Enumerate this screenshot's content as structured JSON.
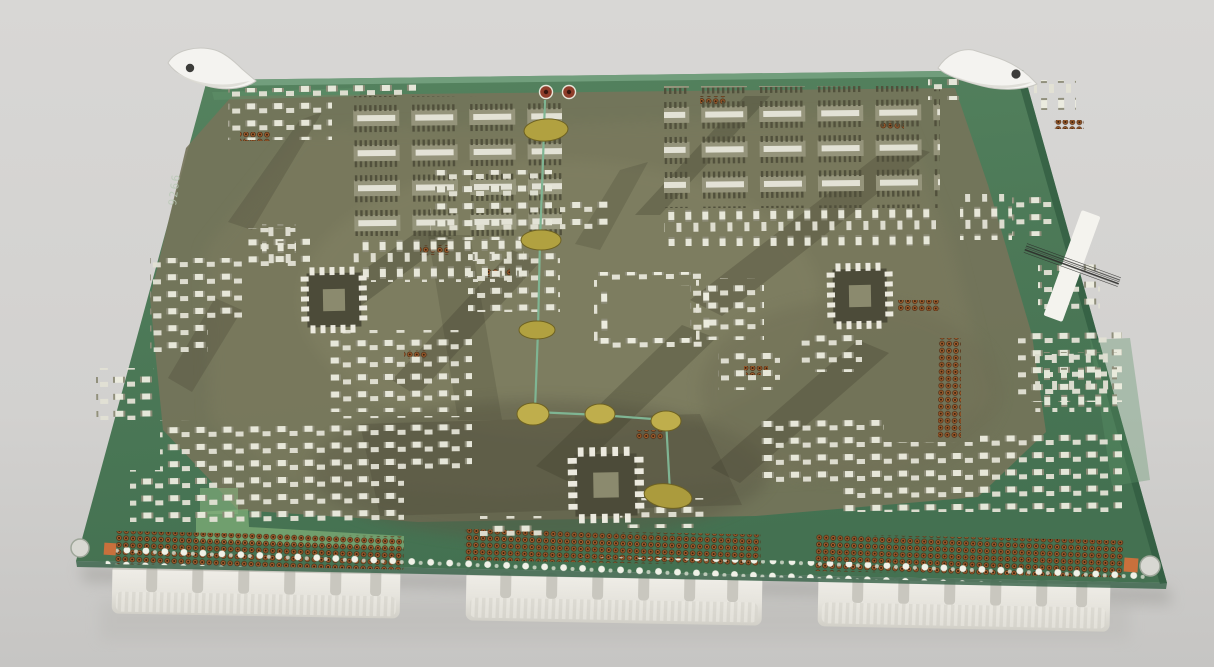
{
  "photo": {
    "subject": "green printed circuit board viewed at an angle on a gray surface",
    "board": {
      "silkscreen_marking": "9266",
      "edge_connector_count": 3,
      "ejector_handle_count": 2,
      "test_point_count": 2,
      "bodge_wire_count": 2,
      "mounting_hole_count": 2,
      "barcode_label": {
        "present": true,
        "text_legible": false
      }
    },
    "palette": {
      "background_top": "#d7d6d4",
      "background_bottom": "#c7c6c4",
      "board_green": "#4f7f5d",
      "board_green_dark": "#3e684b",
      "board_olive": "#77765c",
      "board_olive_dark": "#595845",
      "silkscreen_white": "#eceadf",
      "copper_pin": "#a05f2e",
      "connector_plastic": "#edebe4",
      "handle_plastic": "#f4f3f0",
      "bodge_wire_teal": "#7fb593",
      "glue_gold": "#b1a140",
      "test_point_red": "#8f3d2a",
      "pad_orange": "#c9703c",
      "label_white": "#f4f3ee",
      "barcode_ink": "#2c2c2a"
    }
  }
}
